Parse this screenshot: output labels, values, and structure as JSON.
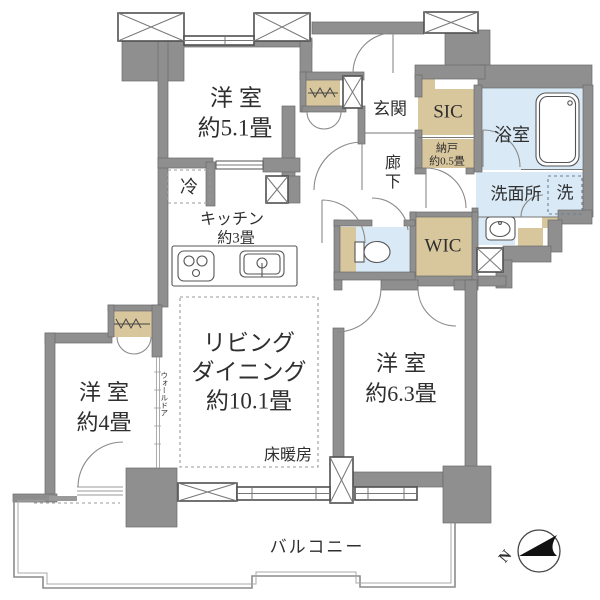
{
  "colors": {
    "wall": "#8f8f8f",
    "closet": "#d8c69d",
    "wet_area": "#d9eaf6",
    "line": "#555555",
    "text": "#2f2f2f"
  },
  "rooms": {
    "bedroom51": {
      "name": "洋室",
      "size": "約5.1畳"
    },
    "kitchen": {
      "name": "キッチン",
      "size": "約3畳"
    },
    "refrigerator": "冷",
    "living": {
      "line1": "リビング",
      "line2": "ダイニング",
      "size": "約10.1畳"
    },
    "floor_heating": "床暖房",
    "bedroom4": {
      "name": "洋室",
      "size": "約4畳"
    },
    "bedroom63": {
      "name": "洋室",
      "size": "約6.3畳"
    },
    "entrance": "玄関",
    "hallway": "廊下",
    "sic": "SIC",
    "storage": {
      "name": "納戸",
      "size": "約0.5畳"
    },
    "bathroom": "浴室",
    "washroom": "洗面所",
    "washer": "洗",
    "wic": "WIC",
    "balcony": "バルコニー",
    "wall_door": "ウォールドア",
    "compass_north": "N"
  },
  "icons": {
    "bathtub": "bathtub-icon",
    "toilet": "toilet-icon",
    "vanity": "vanity-sink-icon",
    "kitchen_sink": "kitchen-sink-icon",
    "stove": "stove-burner-icon",
    "hanger_rail": "hanger-rail-icon",
    "pillar": "pillar-cross-icon",
    "window": "window-icon",
    "door": "door-swing-icon",
    "compass": "compass-icon"
  }
}
